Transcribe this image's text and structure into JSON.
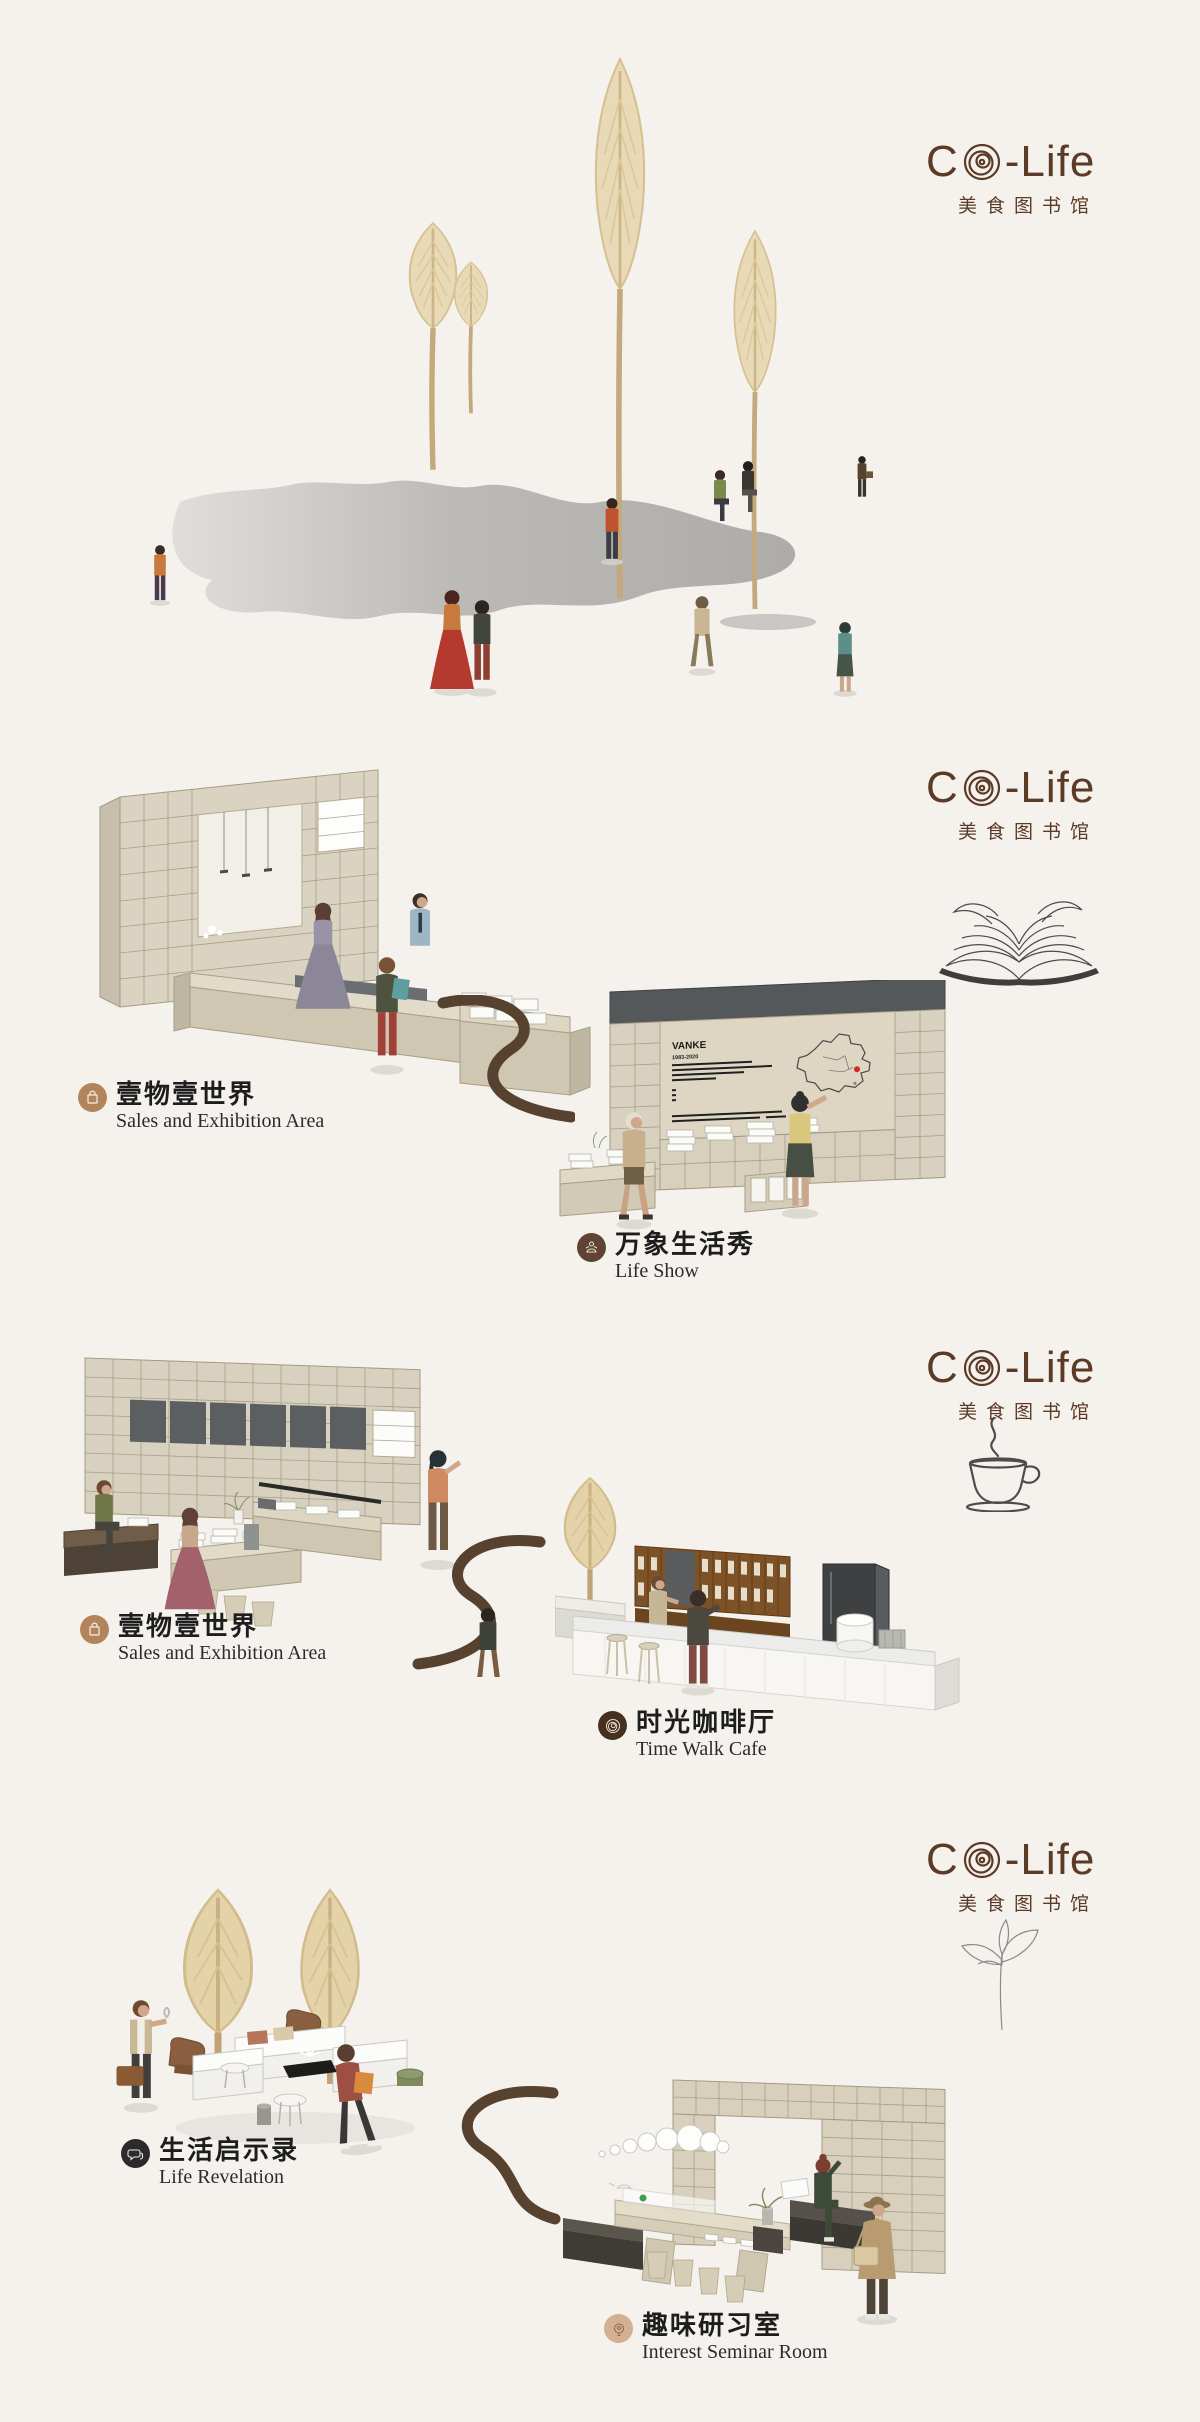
{
  "logo": {
    "prefix": "C",
    "suffix": "-Life",
    "subtitle": "美食图书馆",
    "color": "#5b3a26"
  },
  "sections": [
    {
      "name": "entrance-plaza"
    },
    {
      "name": "sales-exhibition-and-life-show",
      "icon": "open-book-icon"
    },
    {
      "name": "sales-exhibition-and-cafe",
      "icon": "coffee-cup-icon"
    },
    {
      "name": "life-revelation-and-seminar",
      "icon": "sprout-icon"
    }
  ],
  "labels": {
    "sales_a": {
      "zh": "壹物壹世界",
      "en": "Sales and Exhibition Area"
    },
    "life_show": {
      "zh": "万象生活秀",
      "en": "Life Show"
    },
    "sales_b": {
      "zh": "壹物壹世界",
      "en": "Sales and Exhibition Area"
    },
    "cafe": {
      "zh": "时光咖啡厅",
      "en": "Time Walk Cafe"
    },
    "revelation": {
      "zh": "生活启示录",
      "en": "Life Revelation"
    },
    "seminar": {
      "zh": "趣味研习室",
      "en": "Interest Seminar Room"
    }
  },
  "display_panel": {
    "title": "VANKE",
    "subtitle": "1983-2020"
  },
  "colors": {
    "background": "#f5f2ee",
    "logo_brown": "#5b3a26",
    "path_brown": "#57422f",
    "shelf_wood": "#d9d1bf",
    "shelf_line": "#a49a83",
    "dark_panel": "#5c5f62",
    "shadow_gray": "#b3b1ae",
    "pampas": "#e7d9b4",
    "badge_sales": "#b3835a",
    "badge_life_show": "#5f4433",
    "badge_cafe": "#46301f",
    "badge_revelation": "#2b2b2b",
    "badge_seminar": "#d2b091",
    "map_marker": "#cf2b24"
  }
}
